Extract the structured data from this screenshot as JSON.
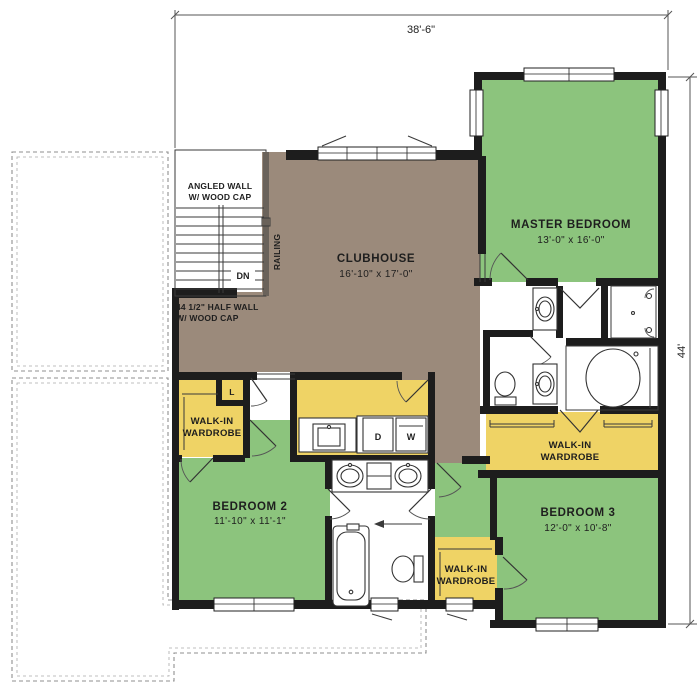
{
  "title": "Second floor plan",
  "dimensions": {
    "top": "38'-6\"",
    "right": "44'"
  },
  "rooms": {
    "clubhouse": {
      "name": "CLUBHOUSE",
      "size": "16'-10\" x 17'-0\""
    },
    "master_bedroom": {
      "name": "MASTER BEDROOM",
      "size": "13'-0\" x 16'-0\""
    },
    "bedroom2": {
      "name": "BEDROOM 2",
      "size": "11'-10\" x 11'-1\""
    },
    "bedroom3": {
      "name": "BEDROOM 3",
      "size": "12'-0\" x 10'-8\""
    }
  },
  "wardrobe": {
    "line1": "WALK-IN",
    "line2": "WARDROBE"
  },
  "annotations": {
    "angled_wall_1": "ANGLED WALL",
    "angled_wall_2": "W/ WOOD CAP",
    "half_wall_1": "44 1/2\" HALF WALL",
    "half_wall_2": "W/ WOOD CAP",
    "railing": "RAILING",
    "down": "DN",
    "linen": "L",
    "dryer": "D",
    "washer": "W"
  },
  "colors": {
    "floor_green": "#8cc47d",
    "floor_brown": "#9b8a7b",
    "floor_yellow": "#efd365",
    "wall": "#1d1d1d"
  }
}
